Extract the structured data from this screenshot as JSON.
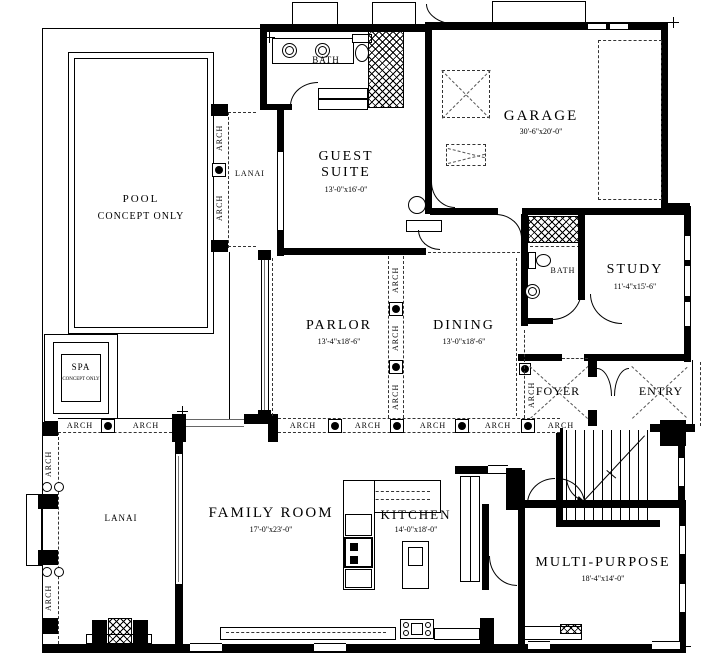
{
  "labels": {
    "arch": "ARCH",
    "pool": {
      "line1": "POOL",
      "line2": "CONCEPT ONLY"
    },
    "spa": {
      "line1": "SPA",
      "line2": "CONCEPT ONLY"
    },
    "lanai_upper": "LANAI",
    "lanai_lower": "LANAI",
    "bath_upper": "BATH",
    "bath_mid": "BATH",
    "guest_suite": {
      "name1": "GUEST",
      "name2": "SUITE",
      "dims": "13'-0\"x16'-0\""
    },
    "garage": {
      "name": "GARAGE",
      "dims": "30'-6\"x20'-0\""
    },
    "study": {
      "name": "STUDY",
      "dims": "11'-4\"x15'-6\""
    },
    "parlor": {
      "name": "PARLOR",
      "dims": "13'-4\"x18'-6\""
    },
    "dining": {
      "name": "DINING",
      "dims": "13'-0\"x18'-6\""
    },
    "foyer": "FOYER",
    "entry": "ENTRY",
    "family_room": {
      "name": "FAMILY ROOM",
      "dims": "17'-0\"x23'-0\""
    },
    "kitchen": {
      "name": "KITCHEN",
      "dims": "14'-0\"x18'-0\""
    },
    "multi_purpose": {
      "name": "MULTI-PURPOSE",
      "dims": "18'-4\"x14'-0\""
    }
  },
  "colors": {
    "wall": "#000000",
    "background": "#ffffff"
  }
}
